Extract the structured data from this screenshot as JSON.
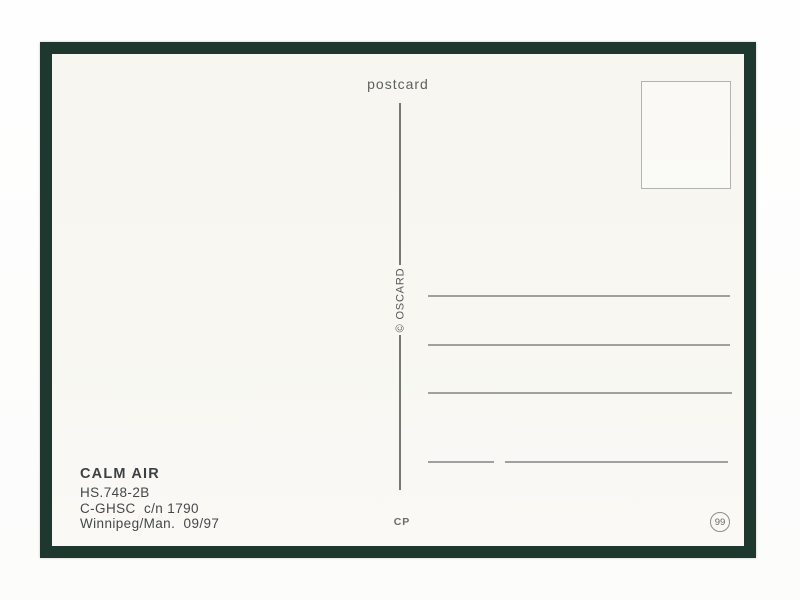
{
  "postcard": {
    "header_label": "postcard",
    "publisher_credit": "© OSCARD",
    "caption": {
      "airline": "CALM AIR",
      "line_type": "HS.748-2B",
      "line_registration": "C-GHSC  c/n 1790",
      "line_location_date": "Winnipeg/Man.  09/97"
    },
    "printer_mark": "CP",
    "card_number": "99"
  },
  "colors": {
    "frame_green": "#1e3830",
    "card_cream": "#f8f7f2",
    "ink_gray": "#45484b",
    "line_gray": "#a0a0a0"
  }
}
